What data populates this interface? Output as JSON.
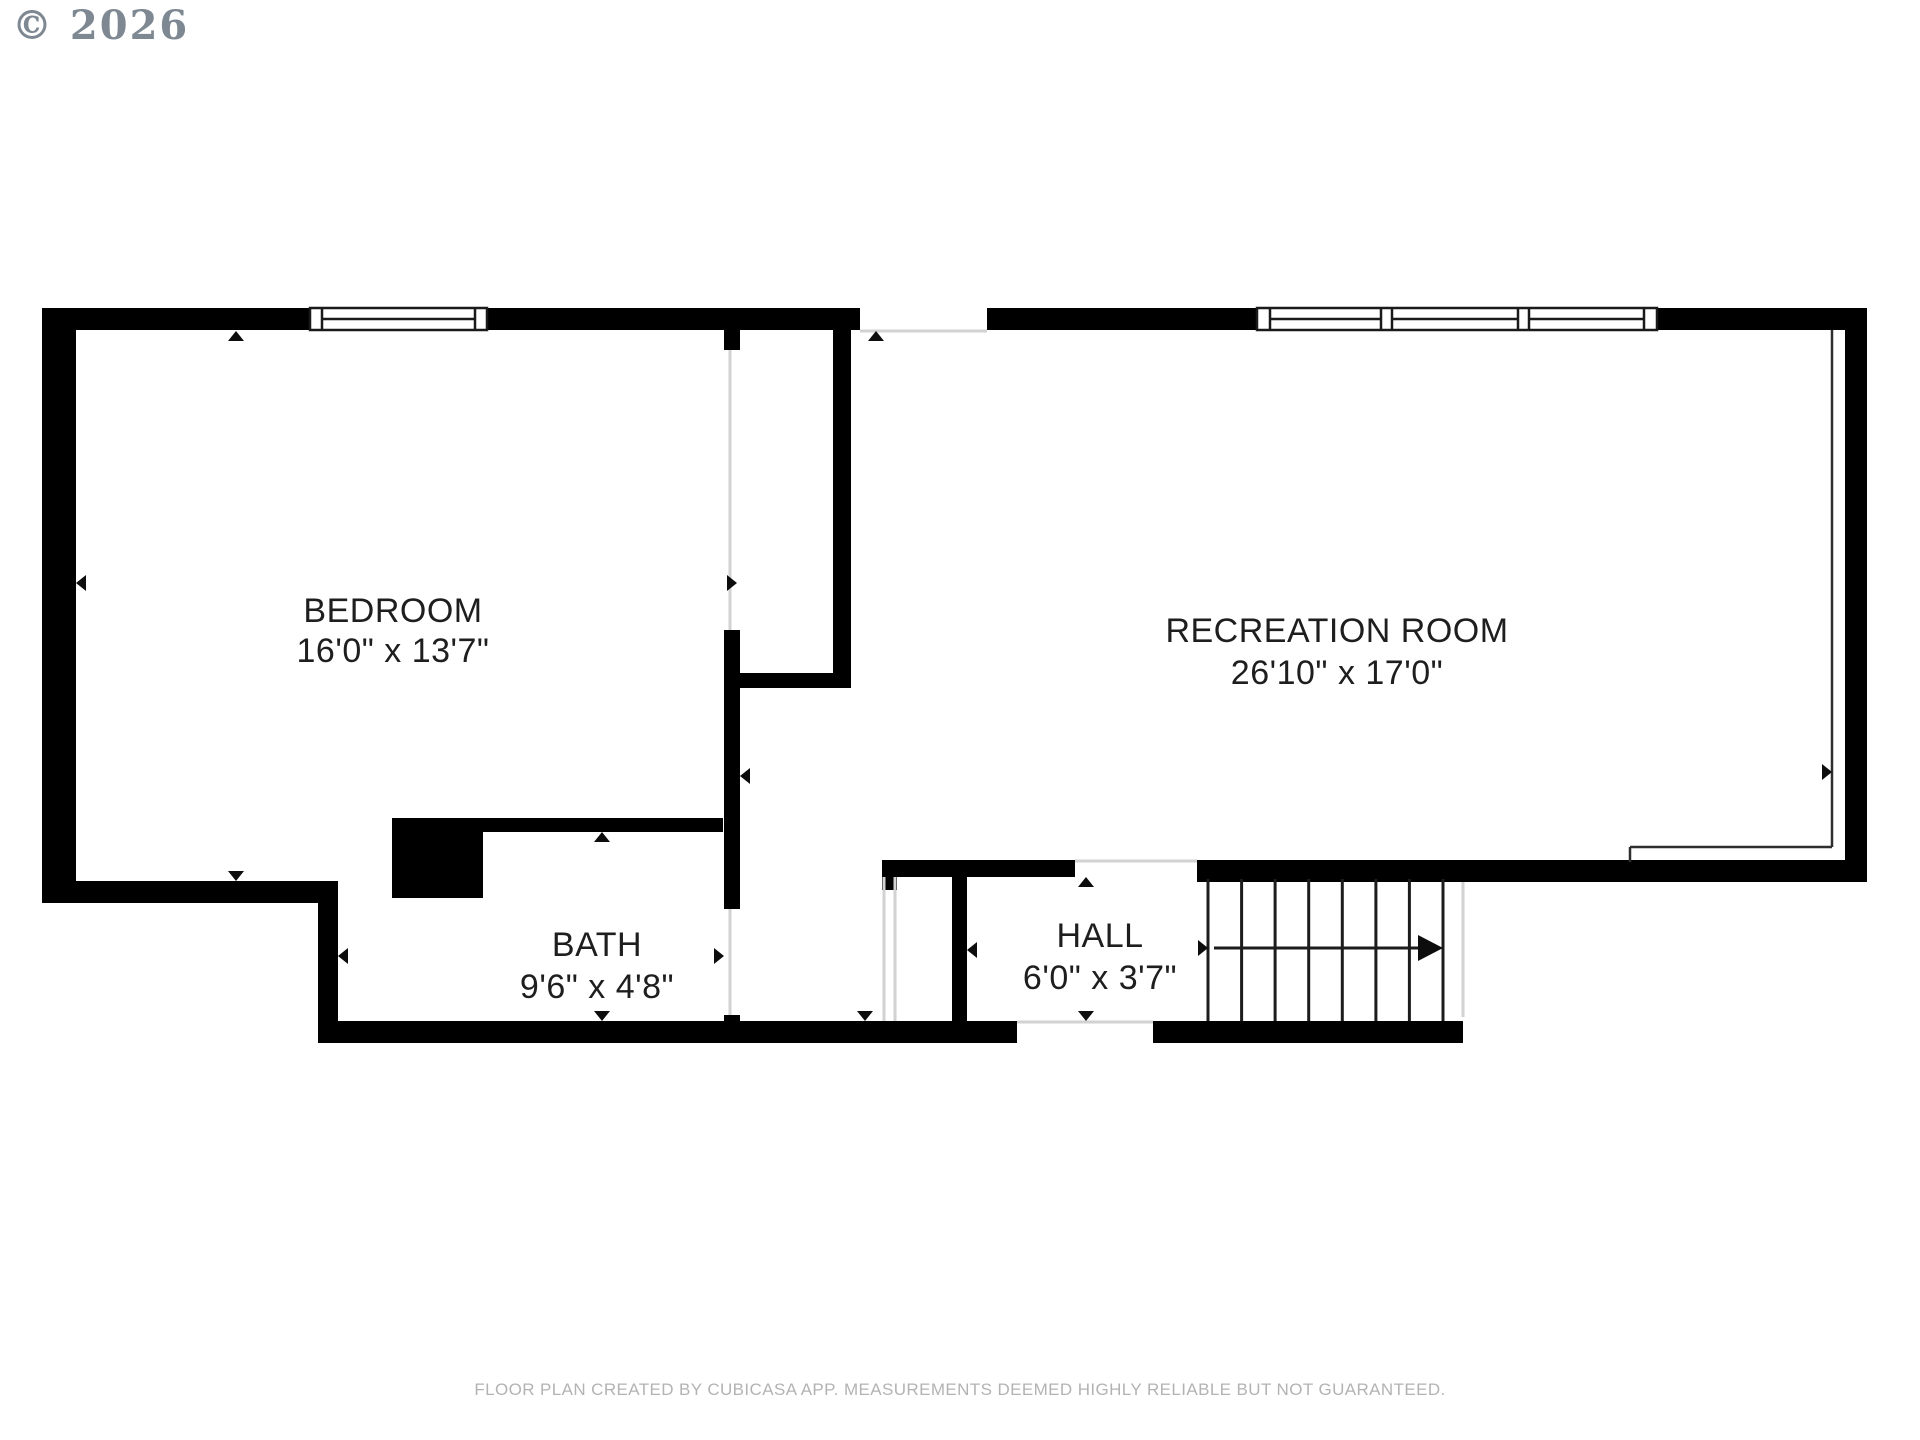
{
  "copyright": "© 2026",
  "rooms": [
    {
      "name": "BEDROOM",
      "dimensions": "16'0\" x 13'7\""
    },
    {
      "name": "RECREATION ROOM",
      "dimensions": "26'10\" x 17'0\""
    },
    {
      "name": "BATH",
      "dimensions": "9'6\" x 4'8\""
    },
    {
      "name": "HALL",
      "dimensions": "6'0\" x 3'7\""
    }
  ],
  "footer": {
    "disclaimer": "FLOOR PLAN CREATED BY CUBICASA APP. MEASUREMENTS DEEMED HIGHLY RELIABLE BUT NOT GUARANTEED."
  },
  "colors": {
    "wall": "#000000",
    "label": "#1e1e1e",
    "opening_line": "#d2d2d2",
    "copyright": "#7e8892",
    "disclaimer": "#b3b3b3",
    "background": "#ffffff"
  }
}
